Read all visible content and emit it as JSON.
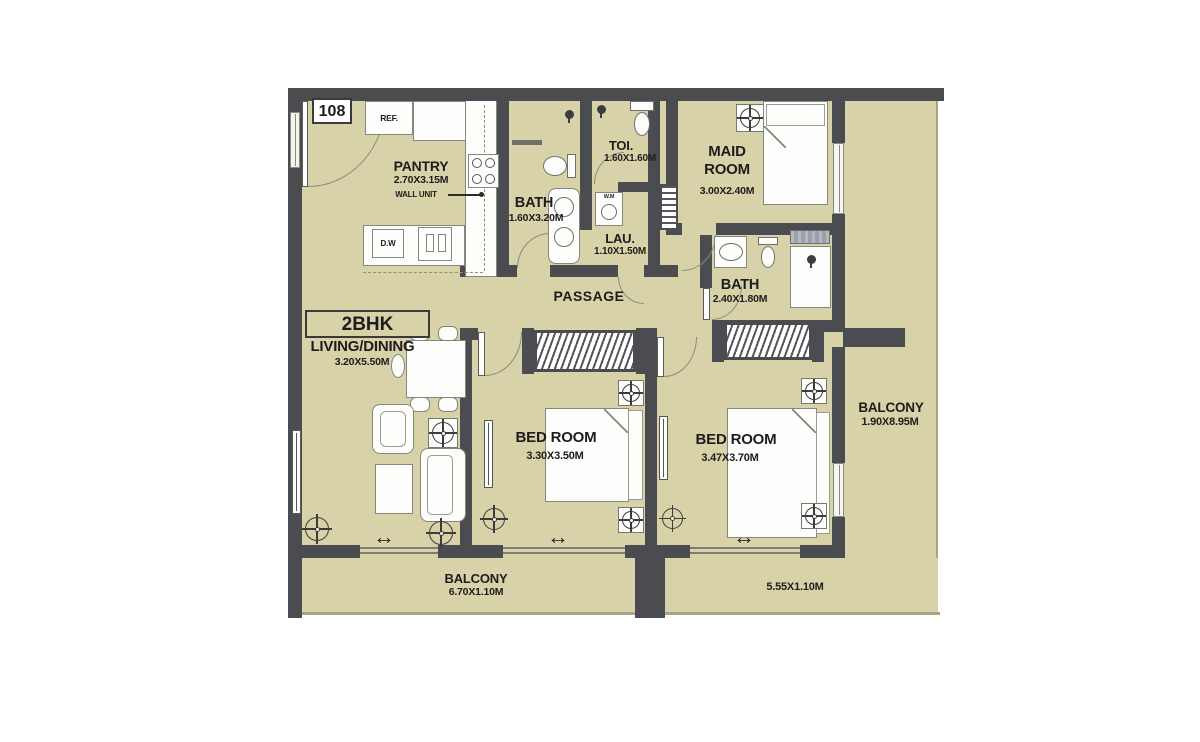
{
  "unit": {
    "number": "108",
    "type": "2BHK"
  },
  "rooms": {
    "pantry": {
      "name": "PANTRY",
      "dims": "2.70X3.15M"
    },
    "bath1": {
      "name": "BATH",
      "dims": "1.60X3.20M"
    },
    "toilet": {
      "name": "TOI.",
      "dims": "1.60X1.60M"
    },
    "laundry": {
      "name": "LAU.",
      "dims": "1.10X1.50M"
    },
    "maid": {
      "line1": "MAID",
      "line2": "ROOM",
      "dims": "3.00X2.40M"
    },
    "bath2": {
      "name": "BATH",
      "dims": "2.40X1.80M"
    },
    "passage": {
      "name": "PASSAGE"
    },
    "living": {
      "name": "LIVING/DINING",
      "dims": "3.20X5.50M"
    },
    "bedroom1": {
      "name": "BED ROOM",
      "dims": "3.30X3.50M"
    },
    "bedroom2": {
      "name": "BED ROOM",
      "dims": "3.47X3.70M"
    },
    "balcony_right": {
      "name": "BALCONY",
      "dims": "1.90X8.95M"
    },
    "balcony_bottom": {
      "name": "BALCONY",
      "dims": "6.70X1.10M"
    },
    "balcony_bottom_right": {
      "dims": "5.55X1.10M"
    }
  },
  "fixtures": {
    "fridge": "REF.",
    "dishwasher": "D.W",
    "washing_machine": "W.M",
    "wall_unit": "WALL UNIT"
  },
  "icons": {
    "sliding_door_arrow": "↔"
  },
  "colors": {
    "floor": "#d8d2a8",
    "wall": "#4b4c50",
    "outline": "#85867d",
    "text": "#1d1d1d",
    "background": "#ffffff",
    "threshold_gray": "#9ba1a9"
  }
}
